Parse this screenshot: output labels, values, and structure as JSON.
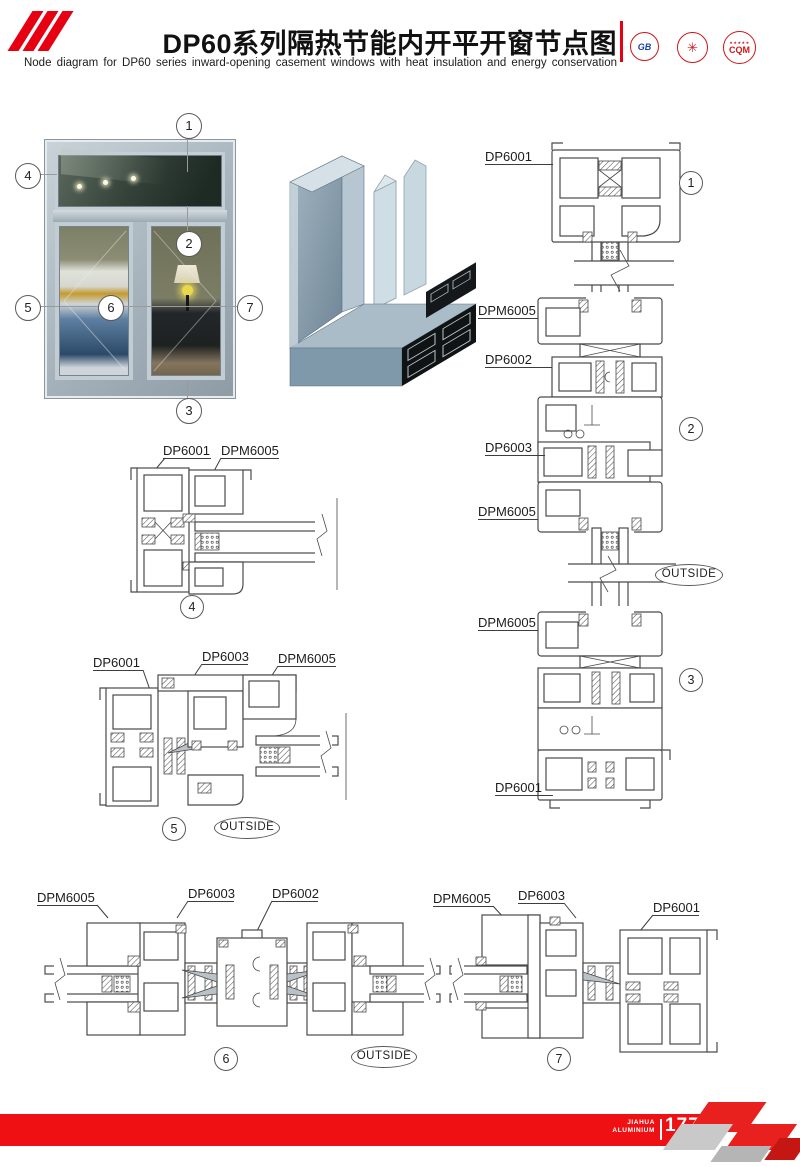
{
  "header": {
    "title": "DP60系列隔热节能内开平开窗节点图",
    "subtitle": "Node diagram for DP60 series inward-opening casement windows with heat insulation and energy conservation",
    "logo1_text": "GB",
    "logo2_glyph": "✳",
    "logo3_stars": "★★★★★",
    "logo3_text": "CQM",
    "accent_color": "#e60012"
  },
  "callouts": {
    "n1": "1",
    "n2": "2",
    "n3": "3",
    "n4": "4",
    "n5": "5",
    "n6": "6",
    "n7": "7"
  },
  "outside_label": "OUTSIDE",
  "sections": {
    "vertical": {
      "labels": {
        "l1": "DP6001",
        "l2": "DPM6005",
        "l3": "DP6002",
        "l4": "DP6003",
        "l5": "DPM6005",
        "l6": "DPM6005",
        "l7": "DP6001"
      }
    },
    "detail4": {
      "label1": "DP6001",
      "label2": "DPM6005"
    },
    "detail5": {
      "label1": "DP6001",
      "label2": "DP6003",
      "label3": "DPM6005"
    },
    "detail6": {
      "label1": "DPM6005",
      "label2": "DP6003",
      "label3": "DP6002"
    },
    "detail7": {
      "label1": "DPM6005",
      "label2": "DP6003",
      "label3": "DP6001"
    }
  },
  "footer": {
    "brand_top": "JIAHUA",
    "brand_bottom": "ALUMINIUM",
    "page": "177",
    "bar_color": "#ee1012"
  }
}
